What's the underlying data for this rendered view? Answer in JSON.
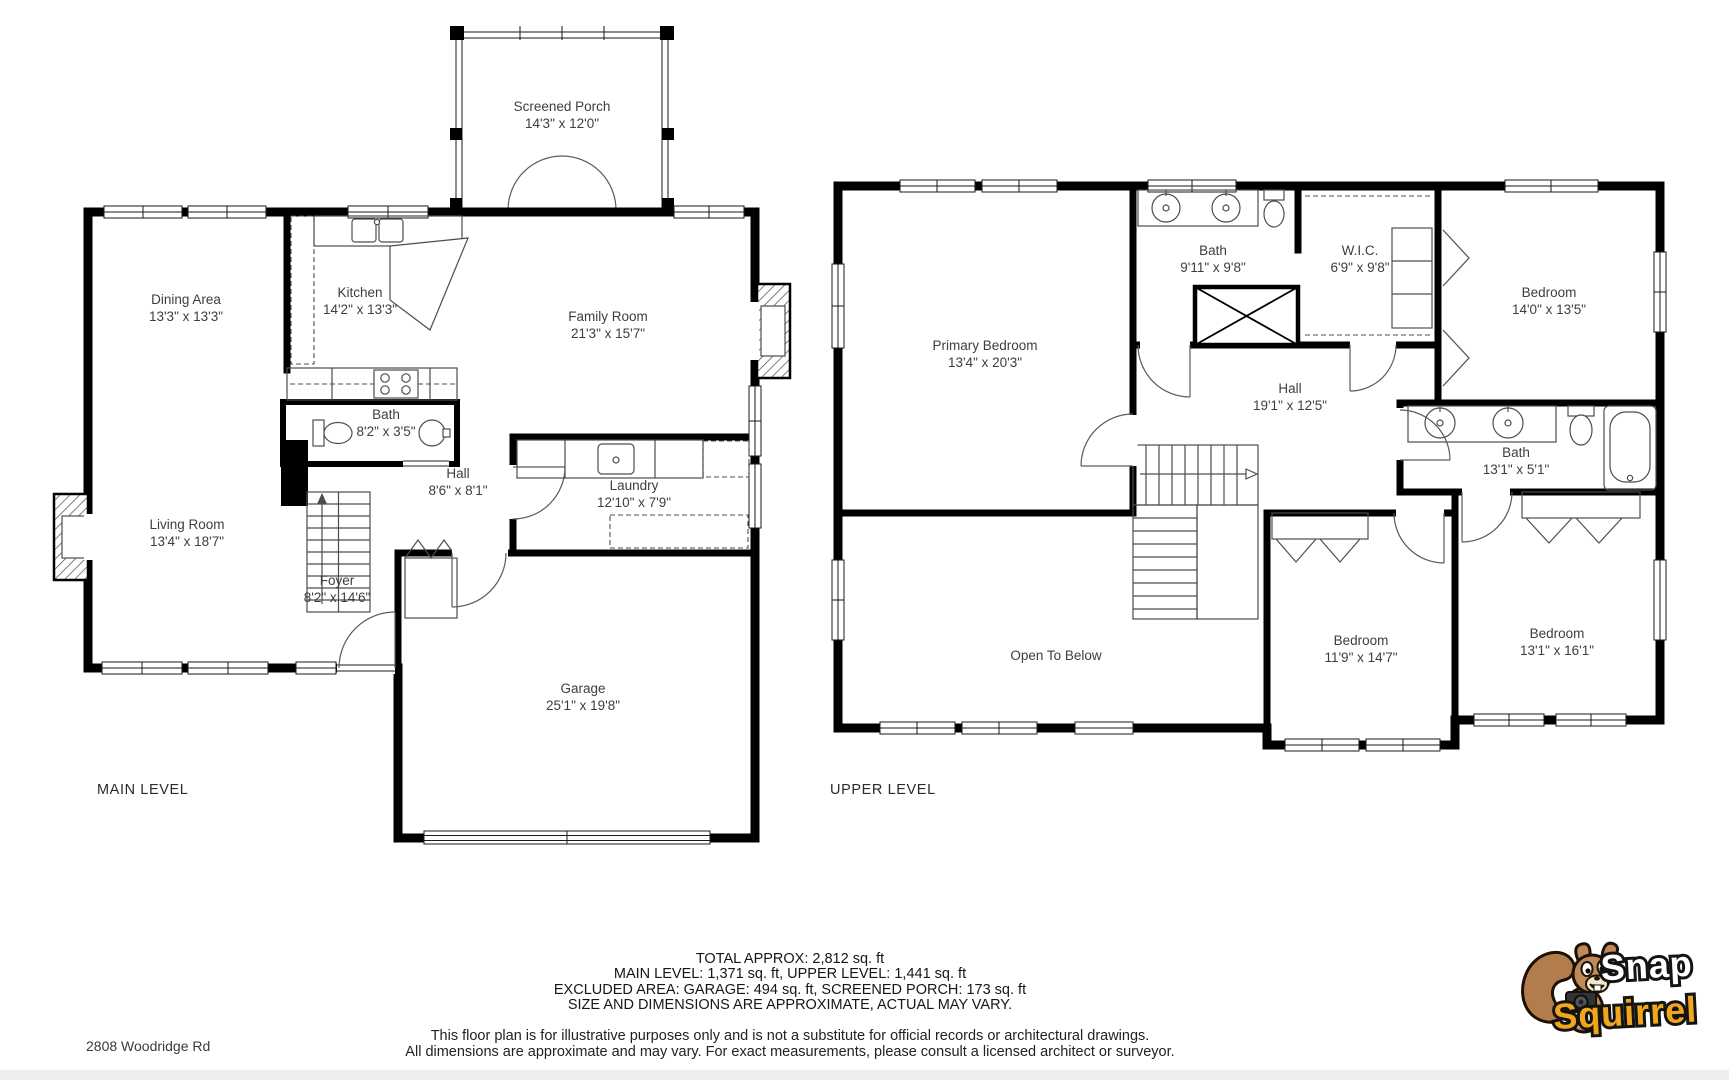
{
  "address": "2808 Woodridge Rd",
  "levels": [
    {
      "label": "MAIN LEVEL",
      "rooms": [
        {
          "name": "Screened Porch",
          "dims": "14'3\" x 12'0\""
        },
        {
          "name": "Dining Area",
          "dims": "13'3\" x 13'3\""
        },
        {
          "name": "Kitchen",
          "dims": "14'2\" x 13'3\""
        },
        {
          "name": "Family Room",
          "dims": "21'3\" x 15'7\""
        },
        {
          "name": "Bath",
          "dims": "8'2\" x 3'5\""
        },
        {
          "name": "Hall",
          "dims": "8'6\" x 8'1\""
        },
        {
          "name": "Laundry",
          "dims": "12'10\" x 7'9\""
        },
        {
          "name": "Living Room",
          "dims": "13'4\" x 18'7\""
        },
        {
          "name": "Foyer",
          "dims": "8'2\" x 14'6\""
        },
        {
          "name": "Garage",
          "dims": "25'1\" x 19'8\""
        }
      ]
    },
    {
      "label": "UPPER LEVEL",
      "rooms": [
        {
          "name": "Primary Bedroom",
          "dims": "13'4\" x 20'3\""
        },
        {
          "name": "Bath",
          "dims": "9'11\" x 9'8\""
        },
        {
          "name": "W.I.C.",
          "dims": "6'9\" x 9'8\""
        },
        {
          "name": "Bedroom",
          "dims": "14'0\" x 13'5\""
        },
        {
          "name": "Hall",
          "dims": "19'1\" x 12'5\""
        },
        {
          "name": "Bath",
          "dims": "13'1\" x 5'1\""
        },
        {
          "name": "Open To Below",
          "dims": ""
        },
        {
          "name": "Bedroom",
          "dims": "11'9\" x 14'7\""
        },
        {
          "name": "Bedroom",
          "dims": "13'1\" x 16'1\""
        }
      ]
    }
  ],
  "summary": {
    "lines": [
      "TOTAL APPROX: 2,812 sq. ft",
      "MAIN LEVEL: 1,371 sq. ft, UPPER LEVEL: 1,441 sq. ft",
      "EXCLUDED AREA: GARAGE: 494 sq. ft, SCREENED PORCH: 173 sq. ft",
      "SIZE AND DIMENSIONS ARE APPROXIMATE, ACTUAL MAY VARY."
    ]
  },
  "disclaimer": {
    "lines": [
      "This floor plan is for illustrative purposes only and is not a substitute for official records or architectural drawings.",
      "All dimensions are approximate and may vary. For exact measurements, please consult a licensed architect or surveyor."
    ]
  },
  "branding": {
    "name_top": "Snap",
    "name_bottom": "Squirrel",
    "accent": "#f2a71b"
  },
  "colors": {
    "wall": "#000000",
    "label": "#3e3e3e",
    "thin_line": "#4d4d4d",
    "background": "#ffffff"
  }
}
